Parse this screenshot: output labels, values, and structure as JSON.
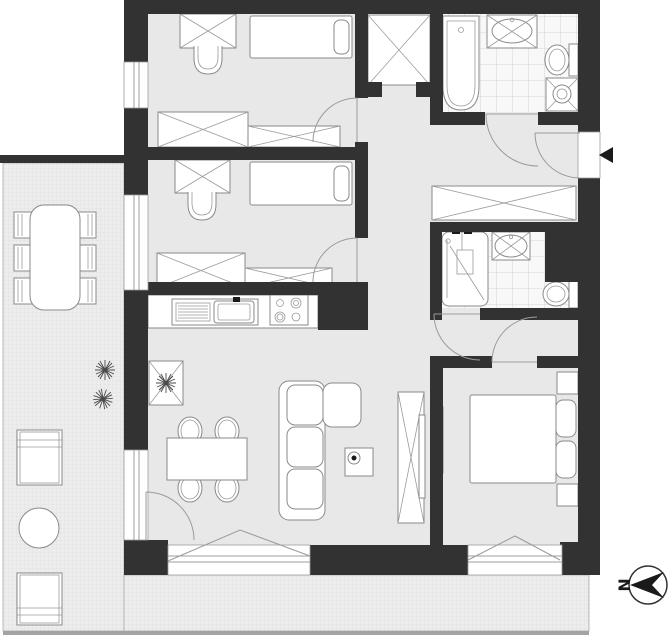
{
  "meta": {
    "type": "apartment-floor-plan",
    "view": "top-down architectural drawing",
    "width_px": 669,
    "height_px": 640
  },
  "compass": {
    "label": "N",
    "arrow_points": "left"
  },
  "entrance": {
    "marker": "filled-left-arrow",
    "wall": "right"
  },
  "palette": {
    "wall": "#323232",
    "room_floor": "#e8e8e8",
    "tiled_floor": "#f8f8f8",
    "tile_line": "#cccccc",
    "terrace_fill": "#ededed",
    "terrace_line": "#dcdcdc",
    "furniture_stroke": "#8a8a8a",
    "baseline": "#a3a3a3",
    "background": "#ffffff"
  },
  "rooms": [
    {
      "id": "bedroom-1",
      "position": "top-left",
      "furniture": [
        "desk",
        "desk-chair",
        "single-bed",
        "wardrobe",
        "wardrobe"
      ]
    },
    {
      "id": "bedroom-2",
      "position": "middle-left",
      "furniture": [
        "desk",
        "desk-chair",
        "single-bed",
        "wardrobe",
        "wardrobe"
      ]
    },
    {
      "id": "bathroom-1",
      "position": "top-right",
      "floor": "tiled",
      "furniture": [
        "bathtub",
        "washbasin",
        "toilet",
        "washing-machine"
      ]
    },
    {
      "id": "hallway",
      "position": "center",
      "furniture": [
        "built-in-wardrobe",
        "built-in-wardrobe"
      ]
    },
    {
      "id": "bathroom-2",
      "position": "middle-right",
      "floor": "tiled",
      "furniture": [
        "shower",
        "washbasin",
        "toilet"
      ]
    },
    {
      "id": "kitchen-living-room",
      "position": "bottom-left",
      "furniture": [
        "kitchen-counter",
        "kitchen-sink",
        "cooktop",
        "plant-stand",
        "dining-table",
        "four-chairs",
        "corner-sofa",
        "side-table-with-lamp",
        "tv-sideboard"
      ]
    },
    {
      "id": "bedroom-3",
      "position": "bottom-right",
      "furniture": [
        "double-bed",
        "nightstand",
        "nightstand",
        "wall-tv"
      ]
    },
    {
      "id": "terrace",
      "position": "left-and-bottom",
      "floor": "pavement-grid",
      "furniture": [
        "outdoor-table",
        "six-outdoor-chairs",
        "lounger",
        "lounger",
        "round-table",
        "plants"
      ]
    }
  ]
}
